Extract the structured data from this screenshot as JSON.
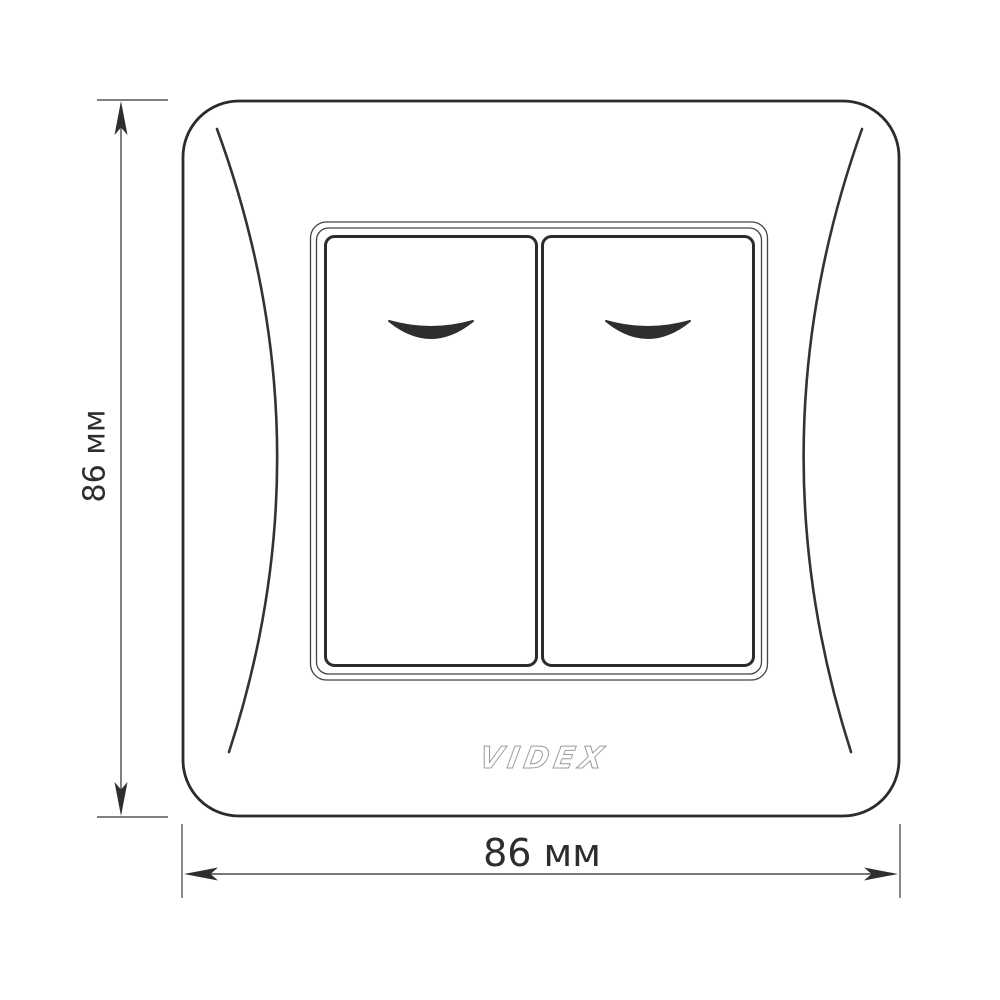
{
  "diagram": {
    "brand": "VIDEX",
    "height_dimension": {
      "label": "86 мм",
      "value_mm": 86,
      "orientation": "vertical"
    },
    "width_dimension": {
      "label": "86 мм",
      "value_mm": 86,
      "orientation": "horizontal"
    },
    "switch": {
      "gang_count": 2,
      "indicator_icon": "curved-rocker-indicator"
    },
    "colors": {
      "background": "#ffffff",
      "plate_outline": "#2b2b2b",
      "accent_curve": "#333333",
      "frame_thin": "#444444",
      "button_border": "#2c2c2c",
      "indicator_fill": "#2e2e2e",
      "dimension_line": "#4a4a4a",
      "extension_line": "#555555",
      "label_text": "#2d2d2d",
      "logo_outline": "#9b9b9b",
      "logo_fill": "#ffffff"
    }
  }
}
